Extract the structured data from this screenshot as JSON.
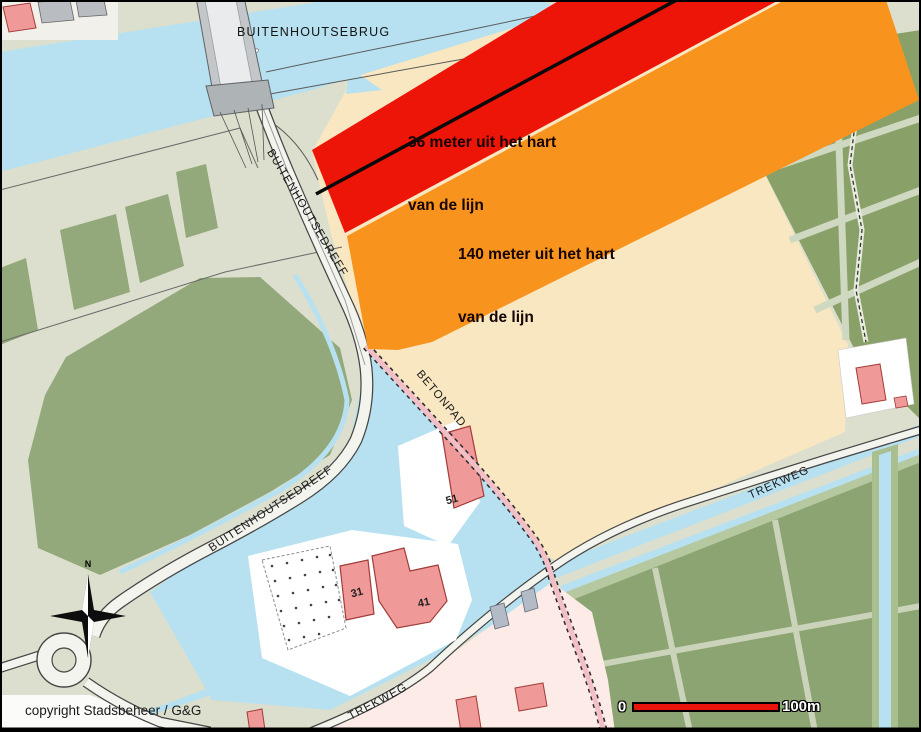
{
  "map": {
    "copyright": "copyright Stadsbeheer / G&G",
    "compass": {
      "north_label": "N"
    },
    "scale_bar": {
      "start_label": "0",
      "end_label": "100m",
      "bar_color": "#e8140c"
    },
    "zones": {
      "zone36": {
        "line1": "36 meter uit het hart",
        "line2": "van de lijn",
        "color": "#ed1408"
      },
      "zone140": {
        "line1": "140 meter uit het hart",
        "line2": "van de lijn",
        "color": "#f8941e"
      }
    },
    "streets": {
      "buitenhoutsebrug": "BUITENHOUTSEBRUG",
      "buitenhoutsedreef_upper": "BUITENHOUTSEDREEF",
      "buitenhoutsedreef_lower": "BUITENHOUTSEDREEF",
      "betonpad": "BETONPAD",
      "trekweg_upper": "TREKWEG",
      "trekweg_lower": "TREKWEG"
    },
    "buildings": {
      "b51": "51",
      "b31": "31",
      "b41": "41"
    },
    "colors": {
      "water": "#b7e1f0",
      "land": "#dcdfcd",
      "field_green": "#93a97b",
      "plot_green": "#8aa069",
      "beige_field": "#f8e7c1",
      "zone_red": "#ed1408",
      "zone_orange": "#f8941e",
      "building_pink": "#ef9a98",
      "pale_pink": "#fcebe6"
    }
  }
}
